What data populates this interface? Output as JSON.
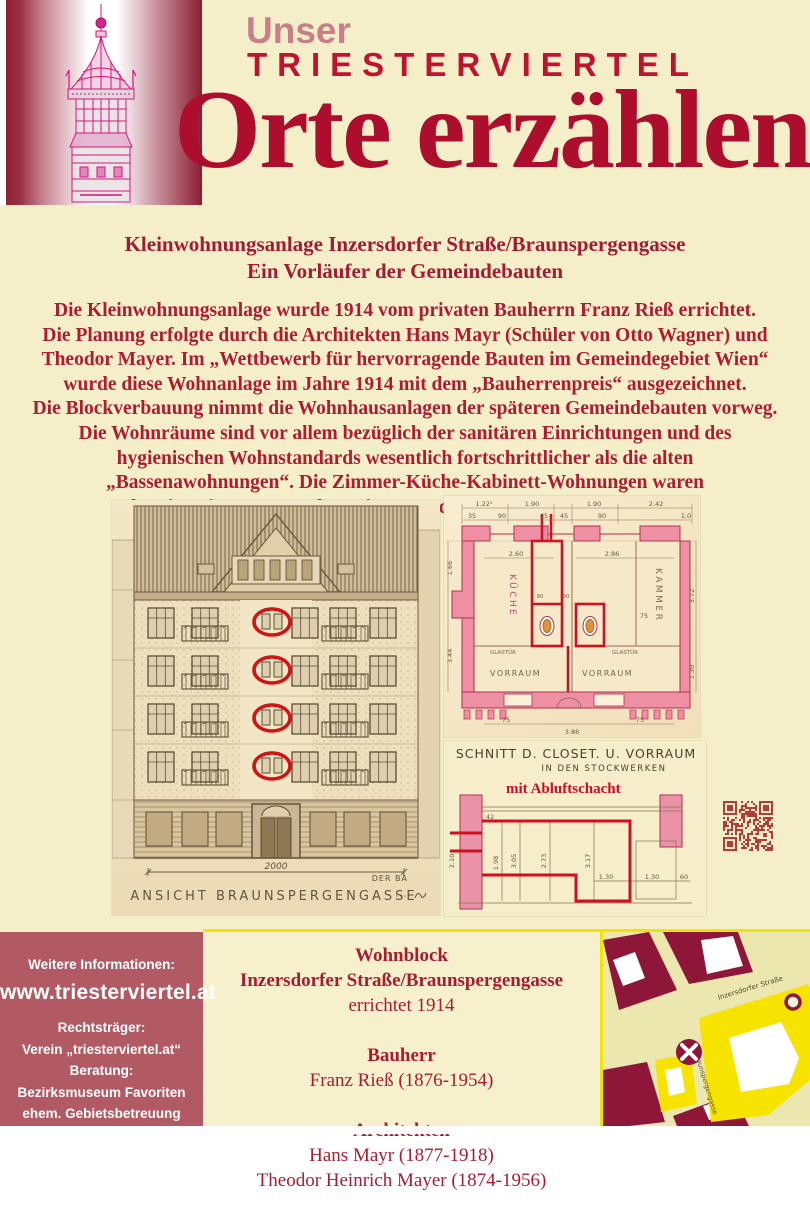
{
  "header": {
    "kicker": "Unser",
    "brand": "TRIESTERVIERTEL",
    "headline": "Orte erzählen"
  },
  "intro": {
    "title_lines": [
      "Kleinwohnungsanlage Inzersdorfer Straße/Braunspergengasse",
      "Ein Vorläufer der Gemeindebauten"
    ],
    "paragraph_lines": [
      "Die Kleinwohnungsanlage wurde 1914 vom privaten Bauherrn Franz Rieß errichtet.",
      "Die Planung erfolgte durch die Architekten Hans Mayr (Schüler von Otto Wagner) und",
      "Theodor Mayer. Im „Wettbewerb für hervorragende Bauten im Gemeindegebiet Wien“",
      "wurde diese Wohnanlage im Jahre 1914 mit dem „Bauherrenpreis“ ausgezeichnet.",
      "Die Blockverbauung nimmt die Wohnhausanlagen der späteren Gemeindebauten vorweg.",
      "Die Wohnräume sind vor allem bezüglich der sanitären Einrichtungen und des",
      "hygienischen Wohnstandards wesentlich fortschrittlicher als die alten",
      "„Bassenawohnungen“. Die Zimmer-Küche-Kabinett-Wohnungen waren",
      "bereits mit Wasser und WC innen und Abluftschacht ausgestattet."
    ]
  },
  "figures": {
    "elevation": {
      "caption": "ANSICHT BRAUNSPERGENGASSE",
      "corner_note": "DER BA",
      "dimension": "2000"
    },
    "plan": {
      "rooms": {
        "kueche": "KÜCHE",
        "kammer": "KAMMER",
        "vorraum_left": "VORRAUM",
        "vorraum_right": "VORRAUM",
        "glastuer_left": "GLASTÜR",
        "glastuer_right": "GLASTÜR"
      },
      "dims": [
        "1.22⁵",
        "1.90",
        "1.90",
        "2.42",
        "35",
        "90",
        "45",
        "45",
        "90",
        "1.0",
        "2.60",
        "2.86",
        "1.66",
        "3.44",
        "3.72",
        "1.30",
        "90",
        "90",
        "75",
        "75",
        "3.86",
        "75"
      ]
    },
    "section": {
      "title": "SCHNITT D. CLOSET. U. VORRAUM",
      "subtitle": "IN DEN STOCKWERKEN",
      "highlight": "mit Abluftschacht",
      "dims": [
        "42",
        "2.10",
        "1.98",
        "3.05",
        "2.73",
        "3.17",
        "1.30",
        "1.30",
        "60"
      ]
    },
    "qr_color": "#b23d36"
  },
  "footer": {
    "info_box": {
      "heading": "Weitere Informationen:",
      "url": "www.triesterviertel.at",
      "lines": [
        "Rechtsträger:",
        "Verein „triesterviertel.at“",
        "Beratung:",
        "Bezirksmuseum Favoriten",
        "ehem. Gebietsbetreuung",
        "Stadterneuerung im 10. Bezirk"
      ]
    },
    "details": {
      "groups": [
        {
          "heading_lines": [
            "Wohnblock",
            "Inzersdorfer Straße/Braunspergengasse"
          ],
          "lines": [
            "errichtet 1914"
          ]
        },
        {
          "heading_lines": [
            "Bauherr"
          ],
          "lines": [
            "Franz Rieß (1876-1954)"
          ]
        },
        {
          "heading_lines": [
            "Architekten"
          ],
          "lines": [
            "Hans Mayr (1877-1918)",
            "Theodor Heinrich Mayer (1874-1956)"
          ]
        }
      ]
    },
    "map": {
      "street_1": "Inzersdorfer Straße",
      "street_2": "Braunspergengasse"
    }
  },
  "colors": {
    "cream": "#f4efc8",
    "dark_red": "#a81c33",
    "headline_red": "#ad0e2d",
    "maroon_box": "#b15a64",
    "map_block": "#8e1638",
    "map_highlight": "#f6e400",
    "separator_yellow": "#f2e300"
  }
}
